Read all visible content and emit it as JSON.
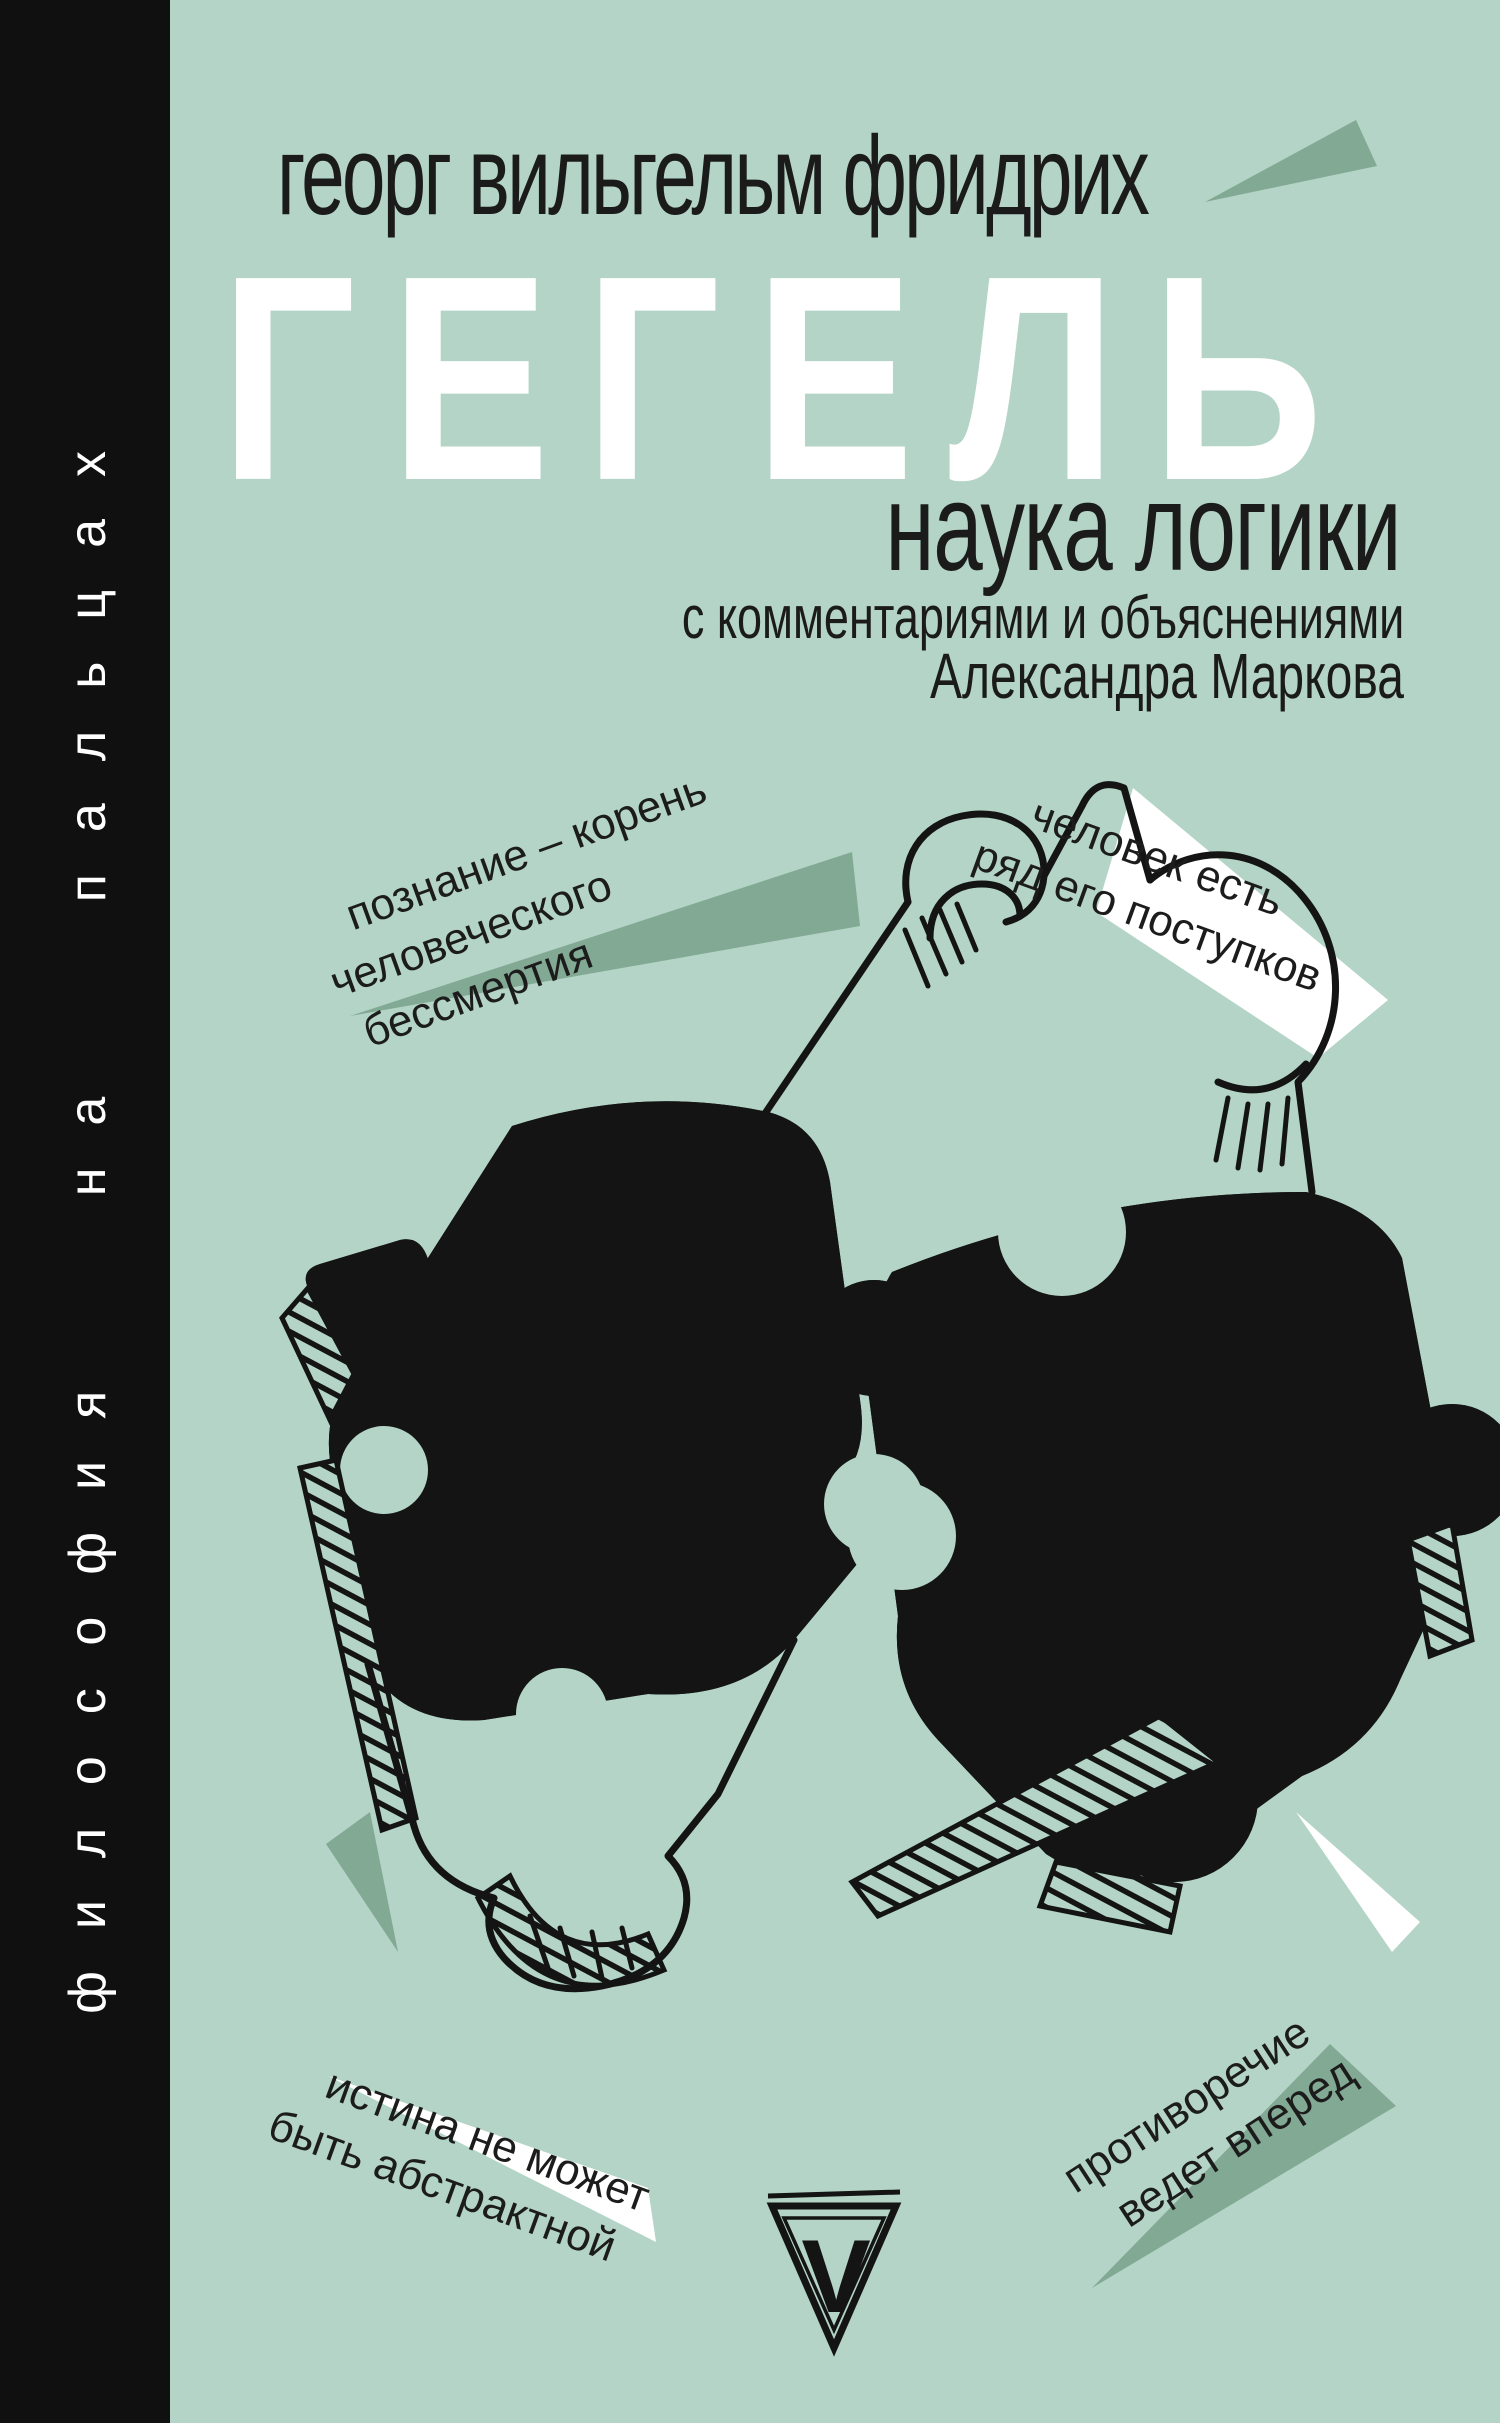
{
  "cover": {
    "series_spine": "философия на пальцах",
    "author_line": "георг вильгельм фридрих",
    "title": "ГЕГЕЛЬ",
    "subtitle": "наука логики",
    "annotation_line1": "с комментариями и объяснениями",
    "annotation_line2": "Александра Маркова",
    "logo_letter": "V"
  },
  "quotes": [
    {
      "lines": [
        "познание – корень",
        "человеческого",
        "бессмертия"
      ]
    },
    {
      "lines": [
        "человек есть",
        "ряд его поступков"
      ]
    },
    {
      "lines": [
        "истина не может",
        "быть абстрактной"
      ]
    },
    {
      "lines": [
        "противоречие",
        "ведет вперед"
      ]
    }
  ],
  "illustration": {
    "description": "two interlocking hand-drawn black jigsaw puzzle pieces with sketch hatching"
  },
  "colors": {
    "background": "#b3d4c6",
    "accent_green": "#82a994",
    "spine_black": "#101010",
    "text_black": "#1b1b1b",
    "white": "#ffffff"
  }
}
